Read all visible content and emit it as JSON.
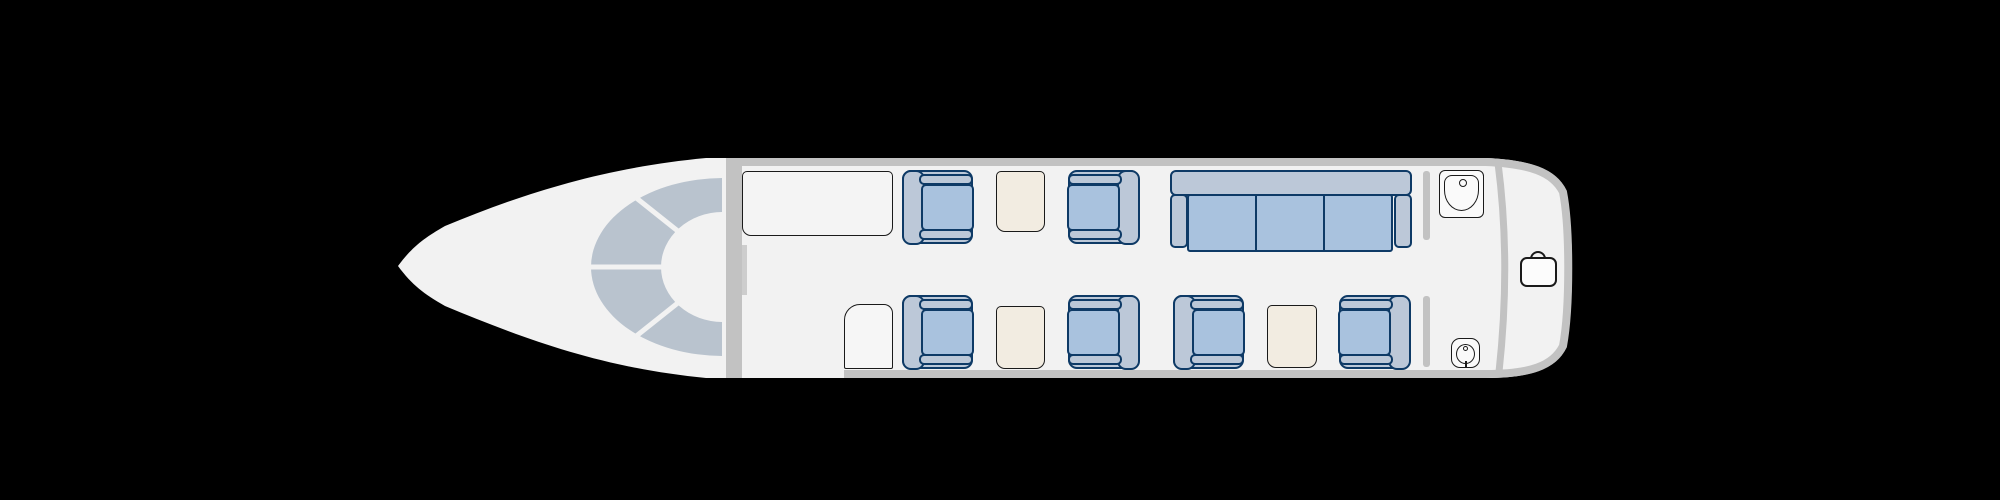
{
  "canvas": {
    "width": 2000,
    "height": 500
  },
  "colors": {
    "bg": "#000000",
    "skin": "#f2f2f2",
    "wall": "#c2c2c2",
    "wall-light": "#cdcdcd",
    "glass": "#b9c3ce",
    "shell": "#bcc8d8",
    "cushion": "#a9c2de",
    "navy": "#0e3a66",
    "cream": "#f2ece1",
    "line": "#1a1a1a",
    "white": "#fafafa"
  },
  "aircraft": {
    "view": "cabin-floorplan-top-view",
    "sections": [
      "cockpit",
      "forward-closet",
      "club-seating",
      "divan",
      "lavatory",
      "baggage"
    ]
  },
  "cabin": {
    "furniture": [
      {
        "type": "cabinet",
        "name": "forward-closet",
        "x": 742,
        "y": 171,
        "w": 151,
        "h": 65,
        "interactable": false
      },
      {
        "type": "seat",
        "name": "seat-1a",
        "x": 902,
        "y": 170,
        "w": 71,
        "h": 74,
        "facing": "right",
        "interactable": true
      },
      {
        "type": "table",
        "name": "table-forward",
        "x": 996,
        "y": 171,
        "w": 49,
        "h": 61,
        "interactable": false
      },
      {
        "type": "seat",
        "name": "seat-1b",
        "x": 1068,
        "y": 170,
        "w": 71,
        "h": 74,
        "facing": "left",
        "interactable": true
      },
      {
        "type": "divan",
        "name": "divan-three-seat",
        "x": 1170,
        "y": 170,
        "w": 242,
        "h": 82,
        "cushions": 3,
        "interactable": true
      },
      {
        "type": "sink",
        "name": "lavatory-sink",
        "x": 1439,
        "y": 170,
        "w": 45,
        "h": 48,
        "interactable": false
      },
      {
        "type": "door",
        "name": "entry-door",
        "x": 844,
        "y": 304,
        "w": 49,
        "h": 65,
        "interactable": false
      },
      {
        "type": "seat",
        "name": "seat-2a",
        "x": 902,
        "y": 295,
        "w": 71,
        "h": 74,
        "facing": "right",
        "interactable": true
      },
      {
        "type": "table",
        "name": "table-mid",
        "x": 996,
        "y": 306,
        "w": 49,
        "h": 63,
        "interactable": false
      },
      {
        "type": "seat",
        "name": "seat-2b",
        "x": 1068,
        "y": 295,
        "w": 71,
        "h": 74,
        "facing": "left",
        "interactable": true
      },
      {
        "type": "seat",
        "name": "seat-3a",
        "x": 1173,
        "y": 295,
        "w": 71,
        "h": 74,
        "facing": "right",
        "interactable": true
      },
      {
        "type": "table",
        "name": "table-aft",
        "x": 1267,
        "y": 305,
        "w": 50,
        "h": 63,
        "interactable": false
      },
      {
        "type": "seat",
        "name": "seat-3b",
        "x": 1339,
        "y": 295,
        "w": 71,
        "h": 74,
        "facing": "left",
        "interactable": true
      },
      {
        "type": "toilet",
        "name": "lavatory-toilet",
        "x": 1451,
        "y": 338,
        "w": 29,
        "h": 30,
        "interactable": false
      },
      {
        "type": "suitcase",
        "name": "baggage-icon",
        "x": 1520,
        "y": 251,
        "w": 37,
        "h": 36,
        "interactable": false
      }
    ]
  }
}
